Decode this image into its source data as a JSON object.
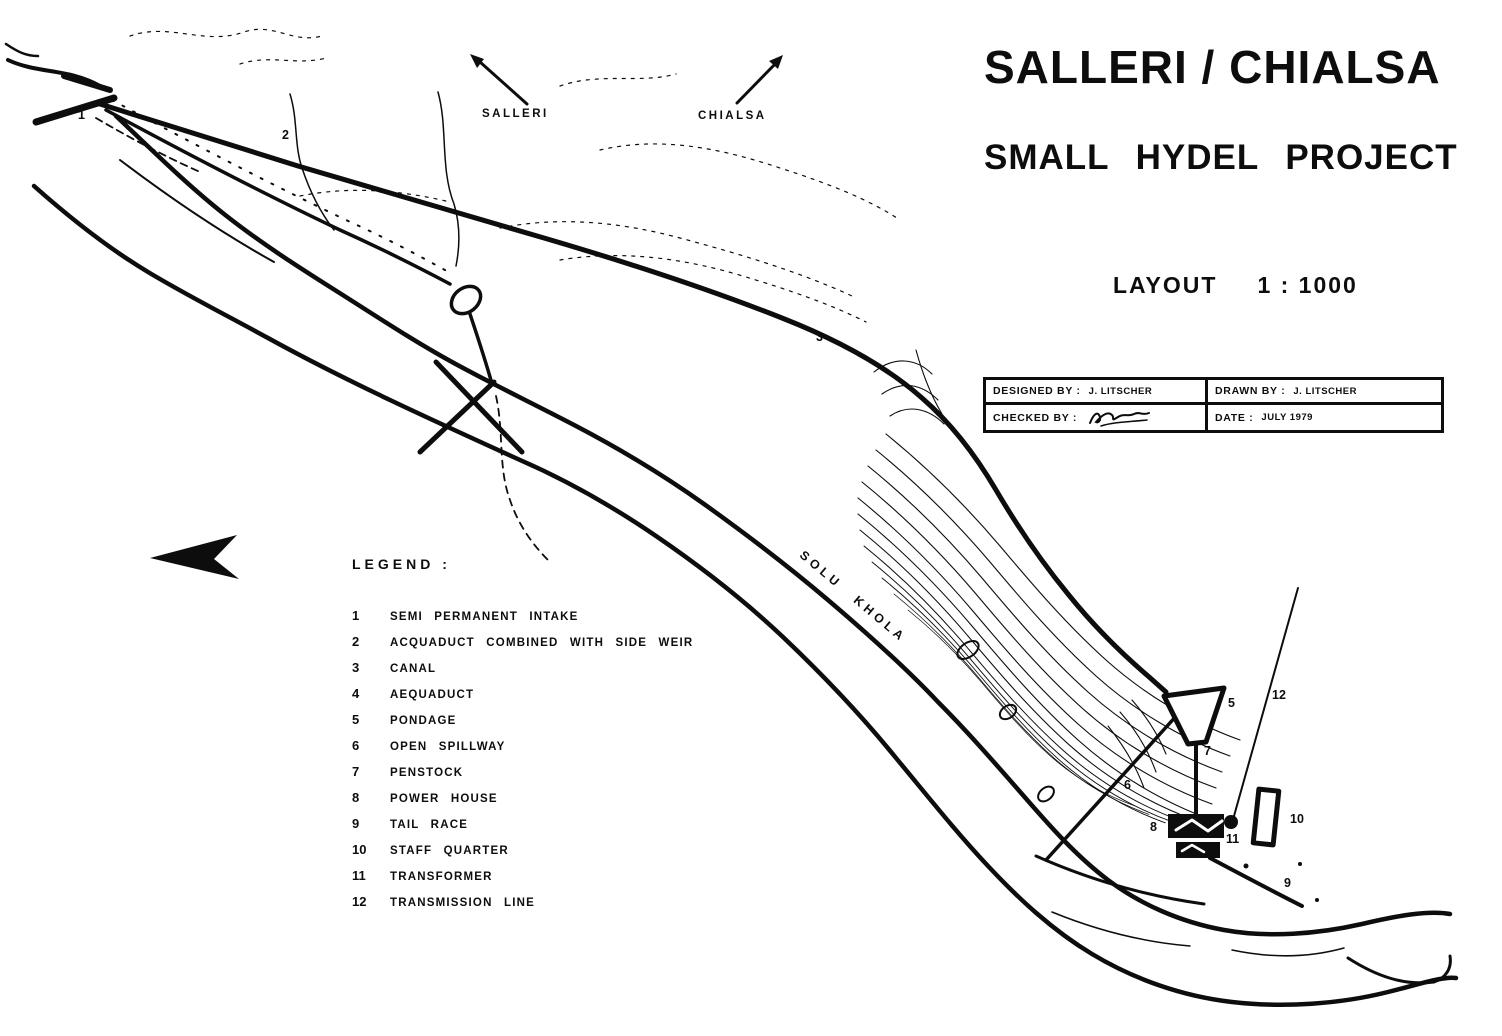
{
  "drawing": {
    "title_line1": "SALLERI / CHIALSA",
    "title_line2": "SMALL HYDEL PROJECT",
    "scale_label": "LAYOUT",
    "scale_value": "1 : 1000",
    "ink_color": "#0d0d0d",
    "paper_color": "#ffffff"
  },
  "title_block": {
    "designed_by_label": "DESIGNED BY :",
    "designed_by_value": "J. LITSCHER",
    "drawn_by_label": "DRAWN BY :",
    "drawn_by_value": "J. LITSCHER",
    "checked_by_label": "CHECKED BY :",
    "date_label": "DATE :",
    "date_value": "JULY 1979"
  },
  "direction_arrows": {
    "left_label": "SALLERI",
    "right_label": "CHIALSA"
  },
  "legend": {
    "title": "LEGEND :",
    "items": [
      {
        "num": "1",
        "label": "SEMI PERMANENT INTAKE"
      },
      {
        "num": "2",
        "label": "ACQUADUCT COMBINED WITH SIDE WEIR"
      },
      {
        "num": "3",
        "label": "CANAL"
      },
      {
        "num": "4",
        "label": "AEQUADUCT"
      },
      {
        "num": "5",
        "label": "PONDAGE"
      },
      {
        "num": "6",
        "label": "OPEN SPILLWAY"
      },
      {
        "num": "7",
        "label": "PENSTOCK"
      },
      {
        "num": "8",
        "label": "POWER HOUSE"
      },
      {
        "num": "9",
        "label": "TAIL RACE"
      },
      {
        "num": "10",
        "label": "STAFF QUARTER"
      },
      {
        "num": "11",
        "label": "TRANSFORMER"
      },
      {
        "num": "12",
        "label": "TRANSMISSION LINE"
      }
    ]
  },
  "map": {
    "river_label": "SOLU KHOLA",
    "labels": [
      {
        "text": "1"
      },
      {
        "text": "2"
      },
      {
        "text": "3"
      },
      {
        "text": "5"
      },
      {
        "text": "6"
      },
      {
        "text": "7"
      },
      {
        "text": "8"
      },
      {
        "text": "9"
      },
      {
        "text": "10"
      },
      {
        "text": "11"
      },
      {
        "text": "12"
      }
    ]
  }
}
